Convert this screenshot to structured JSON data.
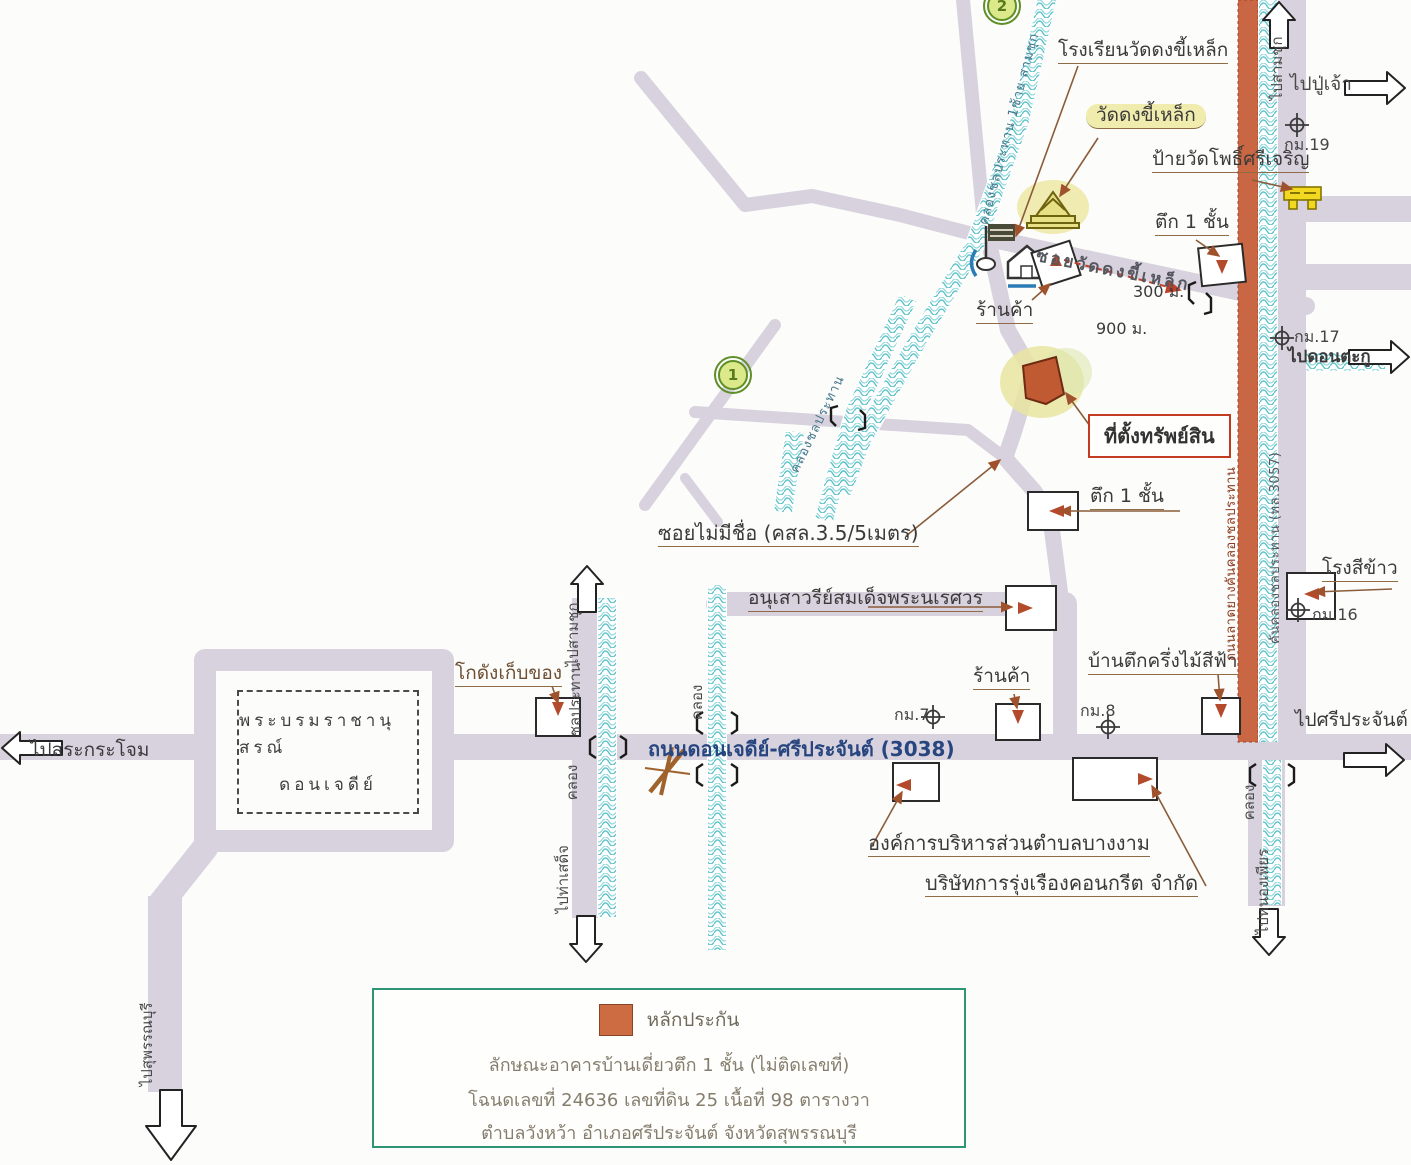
{
  "labels": {
    "school": "โรงเรียนวัดดงขี้เหล็ก",
    "temple": "วัดดงขี้เหล็ก",
    "temple_sign": "ป้ายวัดโพธิ์ศรีเจริญ",
    "km19": "กม.19",
    "to_pu_chao": "ไปปู่เจ้า",
    "to_sam_chuk_right": "ไปสามชุก",
    "one_story_building_top": "ตึก 1 ชั้น",
    "soi_wat_dong": "ซอยวัดดงขี้เหล็ก",
    "dist_300": "300 ม.",
    "dist_900": "900 ม.",
    "shop_top": "ร้านค้า",
    "km17": "กม.17",
    "to_don_ta_ku": "ไปดอนตะกู",
    "property_location": "ที่ตั้งทรัพย์สิน",
    "one_story_building_mid": "ตึก 1 ชั้น",
    "unnamed_soi": "ซอยไม่มีชื่อ (คสล.3.5/5เมตร)",
    "naresuan_monument": "อนุเสาวรีย์สมเด็จพระนเรศวร",
    "warehouse": "โกดังเก็บของ",
    "don_chedi_line1": "พระบรมราชานุสรณ์",
    "don_chedi_line2": "ดอนเจดีย์",
    "to_sa_krajom": "ไปสระกระโจม",
    "main_road": "ถนนดอนเจดีย์-ศรีประจันต์ (3038)",
    "km7": "กม.7",
    "shop_bottom": "ร้านค้า",
    "blue_house": "บ้านตึกครึ่งไม้สีฟ้า",
    "km8": "กม.8",
    "to_si_prachan": "ไปศรีประจันต์",
    "rice_mill": "โรงสีข้าว",
    "km16": "กม.16",
    "sao_bang_ngam": "องค์การบริหารส่วนตำบลบางงาม",
    "concrete_company": "บริษัทการรุ่งเรืองคอนกรีต จำกัด",
    "to_sam_chuk_left": "ไปสามชุก",
    "chonprathan": "ชลประทาน",
    "khlong_left": "คลอง",
    "to_tha_sadet": "ไปท่าเสด็จ",
    "khlong_center": "คลอง",
    "khlong_right": "คลอง",
    "to_nong_phian": "ไปหนองเพียร",
    "to_suphan_buri": "ไปสุพรรณบุรี",
    "canal_main_diag": "คลองชลประทาน 1ซ้าย สามชุก",
    "canal_inner_diag": "คลองชลประทาน",
    "red_road_name": "ถนนลาดยางคันคลองชลประทาน",
    "canal_road_name": "คันคลองชลประทาน (ทล.3057)",
    "circle_1": "1",
    "circle_2": "2"
  },
  "legend": {
    "collateral": "หลักประกัน",
    "line1": "ลักษณะอาคารบ้านเดี่ยวตึก 1 ชั้น (ไม่ติดเลขที่)",
    "line2": "โฉนดเลขที่ 24636 เลขที่ดิน 25 เนื้อที่ 98 ตารางวา",
    "line3": "ตำบลวังหว้า  อำเภอศรีประจันต์  จังหวัดสุพรรณบุรี"
  },
  "colors": {
    "road": "#d8d2de",
    "canal": "#5fc3c8",
    "red_road": "#c96744",
    "property": "#c05a33",
    "highlight": "#efeaa4",
    "legend_border": "#2f9475",
    "property_label_border": "#c23b22",
    "main_road_text": "#27457f"
  }
}
